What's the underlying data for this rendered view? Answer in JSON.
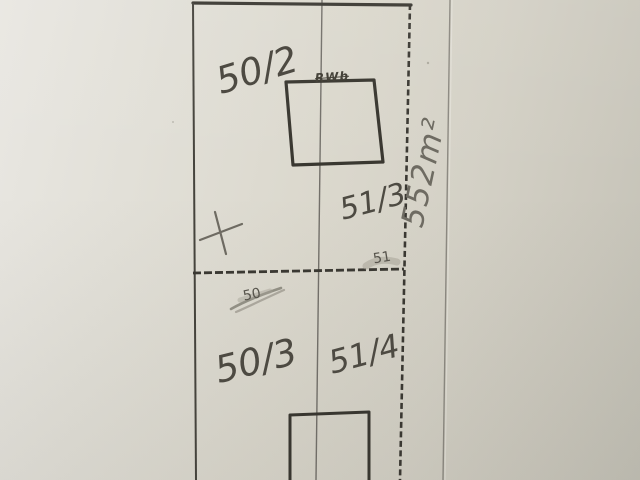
{
  "sketch": {
    "parcels": [
      {
        "position": "top-left",
        "label": "50/2"
      },
      {
        "position": "top-right",
        "label": "51/3"
      },
      {
        "position": "bottom-left",
        "label": "50/3"
      },
      {
        "position": "bottom-right",
        "label": "51/4"
      }
    ],
    "area_label": "552m²",
    "point_markers": [
      {
        "label": "51",
        "state": "smudged"
      },
      {
        "label": "50",
        "state": "crossed-out"
      }
    ],
    "overwritten_note": "RWb",
    "symbols": [
      {
        "name": "survey-cross",
        "description": "pencil plus mark in left parcel"
      }
    ],
    "colors": {
      "paper": "#dbd8cd",
      "boundary_ink": "#3a3832",
      "pencil": "#6e6b62",
      "center_line": "#73706a",
      "fold_line": "#8c8981"
    }
  }
}
